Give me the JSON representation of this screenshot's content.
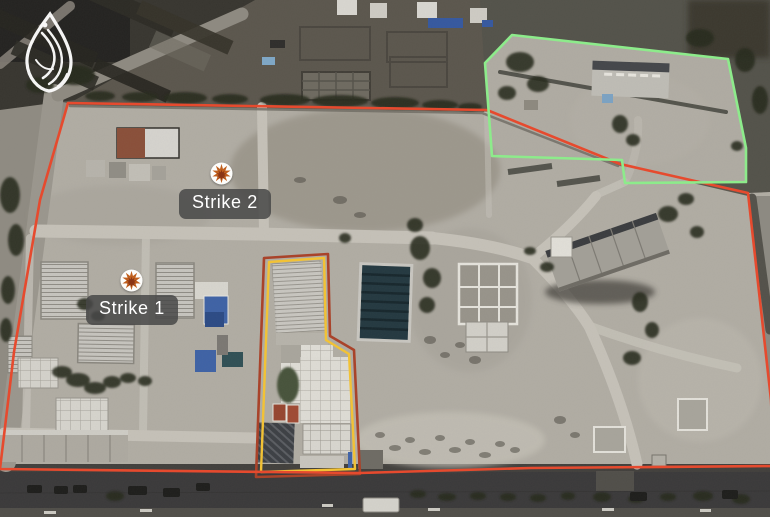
{
  "image": {
    "kind": "annotated-satellite-photo",
    "branding_logo": "al-jazeera-logo"
  },
  "annotations": {
    "strike_markers": [
      {
        "label": "Strike 1",
        "icon": "explosion-fire-icon"
      },
      {
        "label": "Strike 2",
        "icon": "explosion-fire-icon"
      }
    ],
    "outlines": [
      {
        "name": "main-compound-outline",
        "color": "#e64a2e"
      },
      {
        "name": "north-annex-outline",
        "color": "#8deb8b"
      },
      {
        "name": "central-building-outline",
        "color": "#f2c235",
        "outer_color": "#a9432a"
      }
    ],
    "label_style": {
      "background": "#4a4a4a",
      "text_color": "#ffffff"
    }
  }
}
